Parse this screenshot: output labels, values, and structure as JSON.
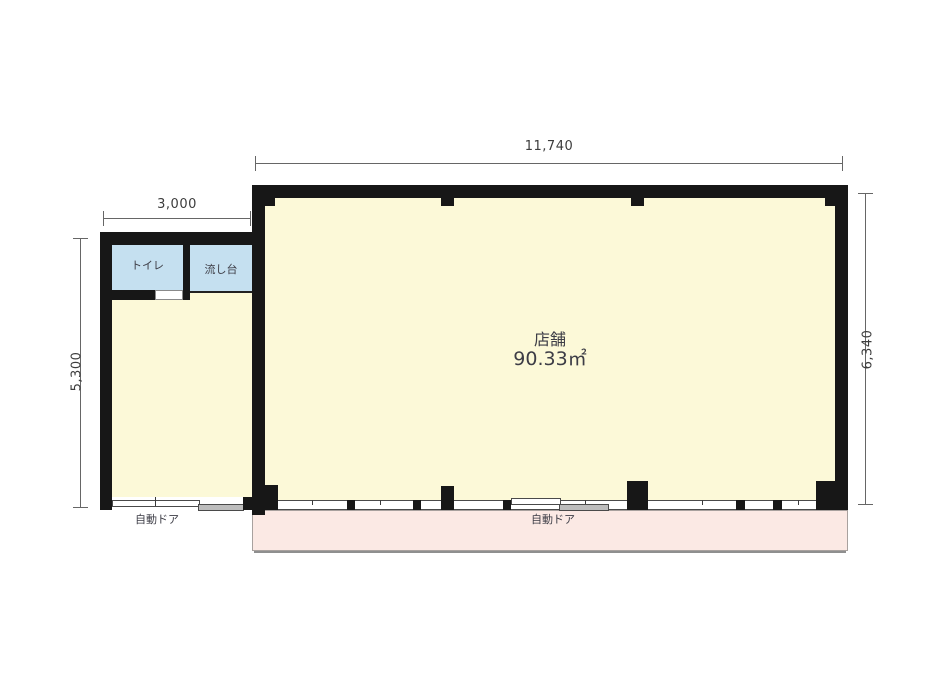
{
  "colors": {
    "wall": "#171717",
    "room_fill": "#FCF9D8",
    "wet_fill": "#C5E0F0",
    "canopy_fill": "#FBE9E4",
    "dim": "#666666",
    "text": "#3A3A3A"
  },
  "rooms": {
    "shop": {
      "name": "店舗",
      "area": "90.33㎡"
    },
    "toilet": {
      "name": "トイレ"
    },
    "sink": {
      "name": "流し台"
    }
  },
  "doors": {
    "annex": {
      "label": "自動ドア"
    },
    "main": {
      "label": "自動ドア"
    }
  },
  "dimensions": {
    "main_width": "11,740",
    "annex_width": "3,000",
    "annex_height": "5,300",
    "main_height": "6,340"
  }
}
